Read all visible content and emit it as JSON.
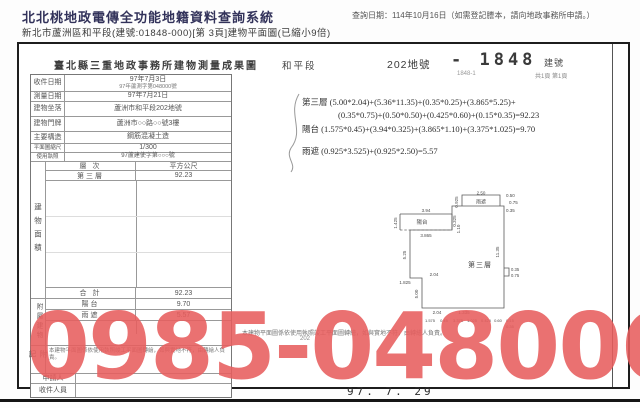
{
  "header": {
    "system_title": "北北桃地政電傳全功能地籍資料查詢系統",
    "doc_line": "新北市蘆洲區和平段(建號:01848-000)[第 3頁]建物平面圖(已縮小9倍)",
    "query_date": "查詢日期：114年10月16日（如需登記謄本，請向地政事務所申請。）"
  },
  "document": {
    "title": "臺北縣三重地政事務所建物測量成果圖",
    "district": "和平段",
    "parcel": "202地號",
    "stamp": {
      "number": "- 1848",
      "label": "建號",
      "sub": "1848-1",
      "page_note": "共1頁 第1頁"
    },
    "scale_note": "比例尺 1/300",
    "info_rows": [
      {
        "label": "收件日期",
        "value": "97年7月3日",
        "value2": "97年蘆測字第048000號"
      },
      {
        "label": "測量日期",
        "value": "97年7月21日"
      },
      {
        "label": "建物坐落",
        "value": "蘆洲市和平段202地號"
      },
      {
        "label": "建物門牌",
        "value": "蘆洲市○○路○○號3樓"
      },
      {
        "label": "主要構造",
        "value": "鋼筋混凝土造"
      },
      {
        "label": "平面圖縮尺",
        "value": "1/300"
      },
      {
        "label": "使用執照",
        "value": "97蘆建使字第○○○號"
      }
    ],
    "area_table": {
      "vertical_label": "建物面積",
      "col_floor": "層 次",
      "col_area": "平方公尺",
      "floor": "第三層",
      "floor_area": "92.23",
      "total_label": "合 計",
      "total_area": "92.23"
    },
    "attached": {
      "vertical_label": "附屬建物",
      "rows": [
        {
          "use": "陽台",
          "area": "9.70"
        },
        {
          "use": "雨遮",
          "area": "5.57"
        }
      ]
    },
    "notes_label": "附記",
    "notes": "本建物平面圖係依使用執照竣工平面圖轉繪，如與實地不符，由轉繪人負責。",
    "applicant_label": "申請人",
    "receiver_label": "收件人員",
    "parcel_tag": "202",
    "date_stamp": "97. 7. 29",
    "formulas": {
      "line1": "第三層 (5.00*2.04)+(5.36*11.35)+(0.35*0.25)+(3.865*5.25)+",
      "line2": "(0.35*0.75)+(0.50*0.50)+(0.425*0.60)+(0.15*0.35)=92.23",
      "line3": "陽台 (1.575*0.45)+(3.94*0.325)+(3.865*1.10)+(3.375*1.025)=9.70",
      "line4": "雨遮 (0.925*3.525)+(0.925*2.50)=5.57"
    },
    "plan": {
      "floor_label": "第三層",
      "balcony_label": "陽台",
      "canopy_label": "雨遮",
      "dims": {
        "top": "3.94",
        "left_top": "1.425",
        "balcony_right": "0.325",
        "balcony_depth": "1.10",
        "dashed": "3.865",
        "left_mid": "5.25",
        "mid": "2.04",
        "left_low": "1.825",
        "left_bottom": "5.00",
        "bottom1": "2.04",
        "bottom2": "1.335",
        "canopy_top": "2.50",
        "canopy_left": "0.925",
        "canopy_right": "0.50",
        "canopy_step1": "0.75",
        "canopy_step2": "0.35",
        "right_wall": "11.35",
        "notch_a": "0.35",
        "notch_b": "0.75",
        "b1": "1.575",
        "b2": "0.45",
        "b3": "3.375",
        "b4": "1.025",
        "b5": "0.425",
        "b6": "0.60",
        "b7": "0.15",
        "b8": "0.35"
      }
    }
  },
  "watermark": {
    "text": "0985-048006",
    "color": "#e85e5e"
  }
}
